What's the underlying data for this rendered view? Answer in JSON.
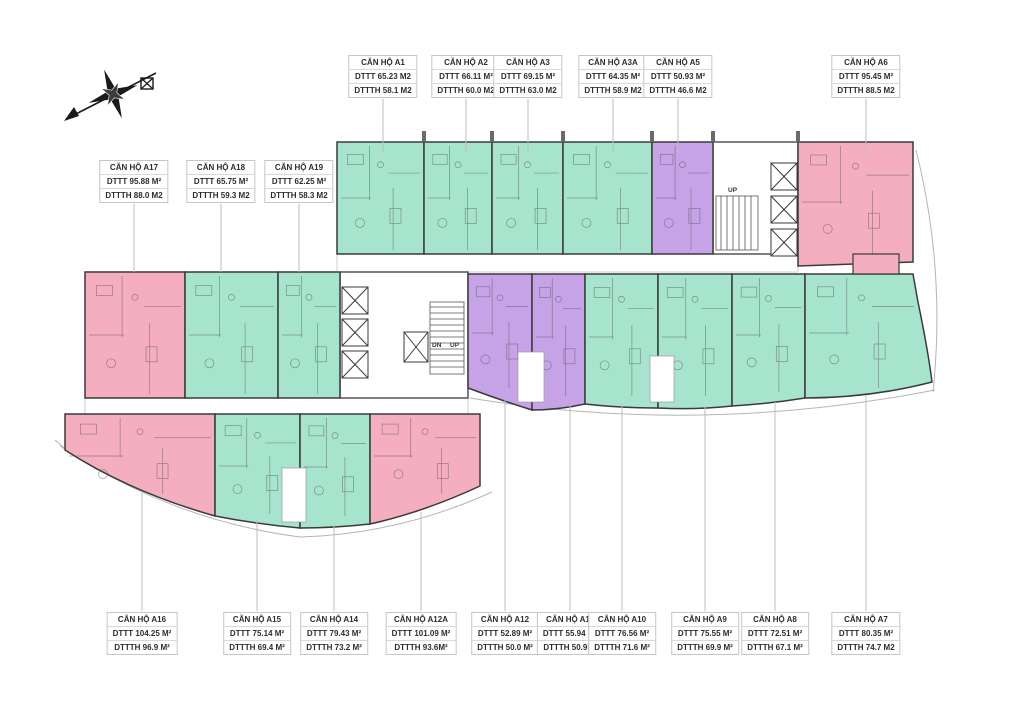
{
  "colors": {
    "teal": "#a7e4ce",
    "pink": "#f5aec0",
    "purple": "#c6a3e7",
    "wall": "#3a3a3a",
    "leader": "#bdbdbd",
    "label_border": "#c6c6c6"
  },
  "icons": {
    "compass": "compass-rose"
  },
  "core_labels": {
    "top_up": "UP",
    "mid_dn": "DN",
    "mid_up": "UP"
  },
  "units": [
    {
      "id": "A1",
      "name": "CĂN HỘ A1",
      "dttt": "DTTT 65.23 M2",
      "dttth": "DTTTH 58.1 M2",
      "color": "teal"
    },
    {
      "id": "A2",
      "name": "CĂN HỘ A2",
      "dttt": "DTTT 66.11 M²",
      "dttth": "DTTTH 60.0 M2",
      "color": "teal"
    },
    {
      "id": "A3",
      "name": "CĂN HỘ A3",
      "dttt": "DTTT 69.15 M²",
      "dttth": "DTTTH 63.0 M2",
      "color": "teal"
    },
    {
      "id": "A3A",
      "name": "CĂN HỘ A3A",
      "dttt": "DTTT 64.35 M²",
      "dttth": "DTTTH 58.9 M2",
      "color": "teal"
    },
    {
      "id": "A5",
      "name": "CĂN HỘ A5",
      "dttt": "DTTT 50.93 M²",
      "dttth": "DTTTH 46.6 M2",
      "color": "purple"
    },
    {
      "id": "A6",
      "name": "CĂN HỘ A6",
      "dttt": "DTTT 95.45 M²",
      "dttth": "DTTTH 88.5 M2",
      "color": "pink"
    },
    {
      "id": "A17",
      "name": "CĂN HỘ A17",
      "dttt": "DTTT 95.88 M²",
      "dttth": "DTTTH 88.0 M2",
      "color": "pink"
    },
    {
      "id": "A18",
      "name": "CĂN HỘ A18",
      "dttt": "DTTT 65.75 M²",
      "dttth": "DTTTH 59.3 M2",
      "color": "teal"
    },
    {
      "id": "A19",
      "name": "CĂN HỘ A19",
      "dttt": "DTTT 62.25 M²",
      "dttth": "DTTTH 58.3 M2",
      "color": "teal"
    },
    {
      "id": "A16",
      "name": "CĂN HỘ A16",
      "dttt": "DTTT 104.25 M²",
      "dttth": "DTTTH 96.9 M²",
      "color": "pink"
    },
    {
      "id": "A15",
      "name": "CĂN HỘ A15",
      "dttt": "DTTT 75.14 M²",
      "dttth": "DTTTH 69.4 M²",
      "color": "teal"
    },
    {
      "id": "A14",
      "name": "CĂN HỘ A14",
      "dttt": "DTTT 79.43 M²",
      "dttth": "DTTTH 73.2 M²",
      "color": "teal"
    },
    {
      "id": "A12A",
      "name": "CĂN HỘ A12A",
      "dttt": "DTTT 101.09 M²",
      "dttth": "DTTTH 93.6M²",
      "color": "pink"
    },
    {
      "id": "A12",
      "name": "CĂN HỘ A12",
      "dttt": "DTTT 52.89 M²",
      "dttth": "DTTTH 50.0 M²",
      "color": "purple"
    },
    {
      "id": "A11",
      "name": "CĂN HỘ A11",
      "dttt": "DTTT 55.94 M²",
      "dttth": "DTTTH 50.9M²",
      "color": "purple"
    },
    {
      "id": "A10",
      "name": "CĂN HỘ A10",
      "dttt": "DTTT 76.56 M²",
      "dttth": "DTTTH 71.6 M²",
      "color": "teal"
    },
    {
      "id": "A9",
      "name": "CĂN HỘ A9",
      "dttt": "DTTT 75.55 M²",
      "dttth": "DTTTH 69.9 M²",
      "color": "teal"
    },
    {
      "id": "A8",
      "name": "CĂN HỘ A8",
      "dttt": "DTTT 72.51 M²",
      "dttth": "DTTTH 67.1 M²",
      "color": "teal"
    },
    {
      "id": "A7",
      "name": "CĂN HỘ A7",
      "dttt": "DTTT 80.35 M²",
      "dttth": "DTTTH 74.7 M2",
      "color": "teal"
    }
  ]
}
